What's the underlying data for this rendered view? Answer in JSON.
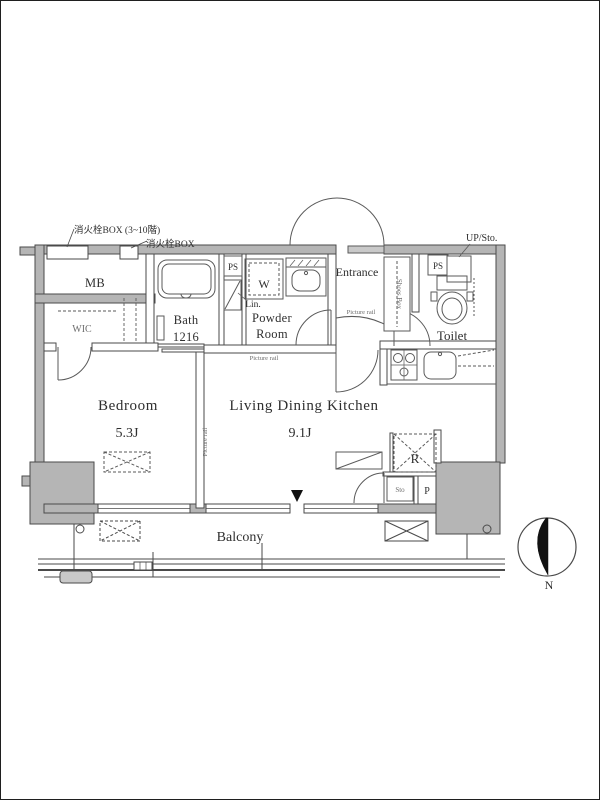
{
  "labels": {
    "fire_box_upper": "消火栓BOX (3~10階)",
    "fire_box_lower": "消火栓BOX",
    "mb": "MB",
    "wic": "WIC",
    "bath_name": "Bath",
    "bath_size": "1216",
    "ps_left": "PS",
    "washer": "W",
    "linen": "Lin.",
    "powder_line1": "Powder",
    "powder_line2": "Room",
    "entrance": "Entrance",
    "shoes_box": "Shoes Box",
    "picture_rail_entrance": "Picture rail",
    "picture_rail_powder": "Picture rail",
    "picture_rail_partition": "Picture rail",
    "ps_right": "PS",
    "up_sto": "UP/Sto.",
    "toilet": "Toilet",
    "bedroom_name": "Bedroom",
    "bedroom_size": "5.3J",
    "ldk_name": "Living Dining Kitchen",
    "ldk_size": "9.1J",
    "refrigerator": "R",
    "storage": "Sto",
    "pipe_space": "P",
    "balcony": "Balcony",
    "compass_north": "N"
  },
  "colors": {
    "wall_fill": "#b5b5b5",
    "door_leaf": "#c9c9c9",
    "line": "#4a4a4a",
    "text_dark": "#2f2f2f",
    "text_gray": "#6e6e6e",
    "compass_needle": "#111111",
    "background": "#ffffff"
  }
}
